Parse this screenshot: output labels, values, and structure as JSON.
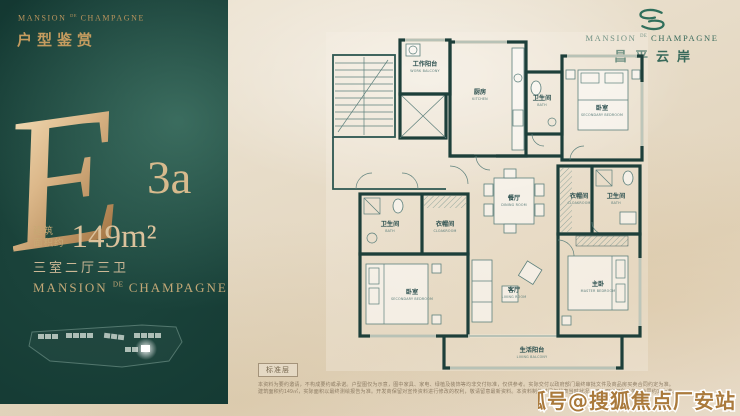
{
  "brand": {
    "left": "MANSION",
    "mid": "DE",
    "right": "CHAMPAGNE",
    "cn": "昌平云岸"
  },
  "left_panel": {
    "section_title": "户型鉴赏",
    "unit_letter": "E",
    "unit_suffix": "3a",
    "area_label_line1": "建筑",
    "area_label_line2": "面积约",
    "area_value": "149m²",
    "layout_text": "三室二厅三卫"
  },
  "floorplan": {
    "floor_tag": "标准层",
    "rooms": [
      {
        "cn": "工作阳台",
        "en": "WORK BALCONY"
      },
      {
        "cn": "厨房",
        "en": "KITCHEN"
      },
      {
        "cn": "卫生间",
        "en": "BATH"
      },
      {
        "cn": "卧室",
        "en": "SECONDARY BEDROOM"
      },
      {
        "cn": "餐厅",
        "en": "DINING ROOM"
      },
      {
        "cn": "衣帽间",
        "en": "CLOAKROOM"
      },
      {
        "cn": "卫生间",
        "en": "BATH"
      },
      {
        "cn": "卫生间",
        "en": "BATH"
      },
      {
        "cn": "衣帽间",
        "en": "CLOAKROOM"
      },
      {
        "cn": "卧室",
        "en": "SECONDARY BEDROOM"
      },
      {
        "cn": "客厅",
        "en": "LIVING ROOM"
      },
      {
        "cn": "主卧",
        "en": "MASTER BEDROOM"
      },
      {
        "cn": "生活阳台",
        "en": "LIVING BALCONY"
      }
    ]
  },
  "disclaimer": {
    "line1": "本资料为要约邀请，不构成要约或承诺。户型图仅为示意，图中家具、家电、绿植及装饰等均非交付标准，仅供参考。实际交付以政府部门最终审批文件及商品房买卖合同约定为准。",
    "line2": "建筑面积约149㎡，实际面积以最终测绘报告为准。开发商保留对宣传资料进行修改的权利，敬请留意最新资料。本资料制作时间仅代表当时状况，买卖双方权利义务以合同约定为准。"
  },
  "watermark": "搜狐号@搜狐焦点厂安站",
  "colors": {
    "panel_green": "#123630",
    "accent_gold": "#c59c5f",
    "logo_green": "#2f6e5b",
    "plan_ink": "#1d3f3a",
    "marble": "#e8decd",
    "watermark_gold": "#aa7a3c"
  }
}
